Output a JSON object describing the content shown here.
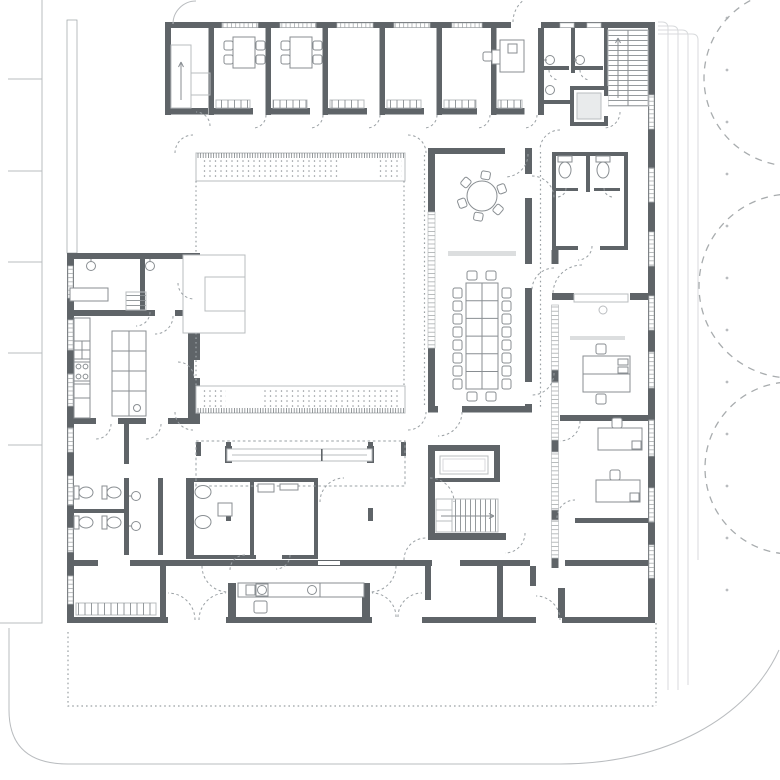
{
  "palette": {
    "bg": "#ffffff",
    "wall": "#5f6468",
    "line_mid": "#898e92",
    "line_light": "#b9bcbf",
    "line_faint": "#d8dadc",
    "dash": "#9aa0a4",
    "shaft": "#e9ebec",
    "shelf": "#dcdedf",
    "dotc": "#8f9498",
    "tree": "#a8acae"
  },
  "site": {
    "tree_count": 3,
    "parking_tick_count": 5,
    "boundary_dot_count": 12,
    "facade_offset_line_count": 4
  },
  "building": {
    "top_office_rooms": 6,
    "top_room_desks": 3,
    "round_table_chairs": 6,
    "conference_side_chairs": 16,
    "conference_end_chairs": 4,
    "east_wing_desks": 4,
    "toilets_west_block": 4,
    "toilets_east_block": 2,
    "stair_count": 5,
    "elevator_count": 1
  }
}
